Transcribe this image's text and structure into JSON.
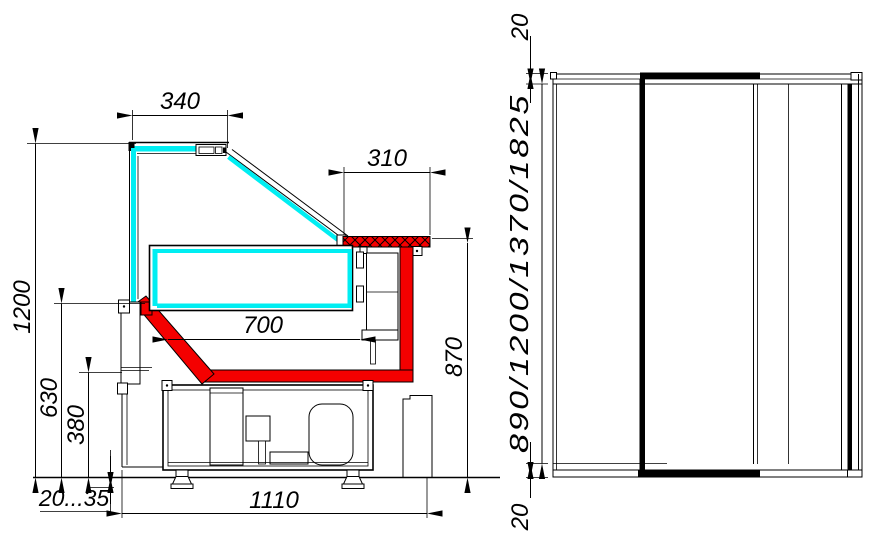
{
  "title": "Refrigerated display case dimensional drawing",
  "views": {
    "section": {
      "label": "side cross-section view",
      "dims": {
        "canopy_width": "340",
        "counter_depth": "310",
        "well_depth": "700",
        "overall_height": "1200",
        "deck_height": "630",
        "base_height": "380",
        "counter_height": "870",
        "foot_range": "20...35",
        "base_depth": "1110"
      }
    },
    "front": {
      "label": "front view",
      "dims": {
        "top_panel": "20",
        "height_variants": "890/1200/1370/1825",
        "bottom_panel": "20"
      }
    }
  },
  "colors": {
    "glass": "#00eef2",
    "accent": "#f40000",
    "line": "#000000",
    "background": "#ffffff"
  }
}
